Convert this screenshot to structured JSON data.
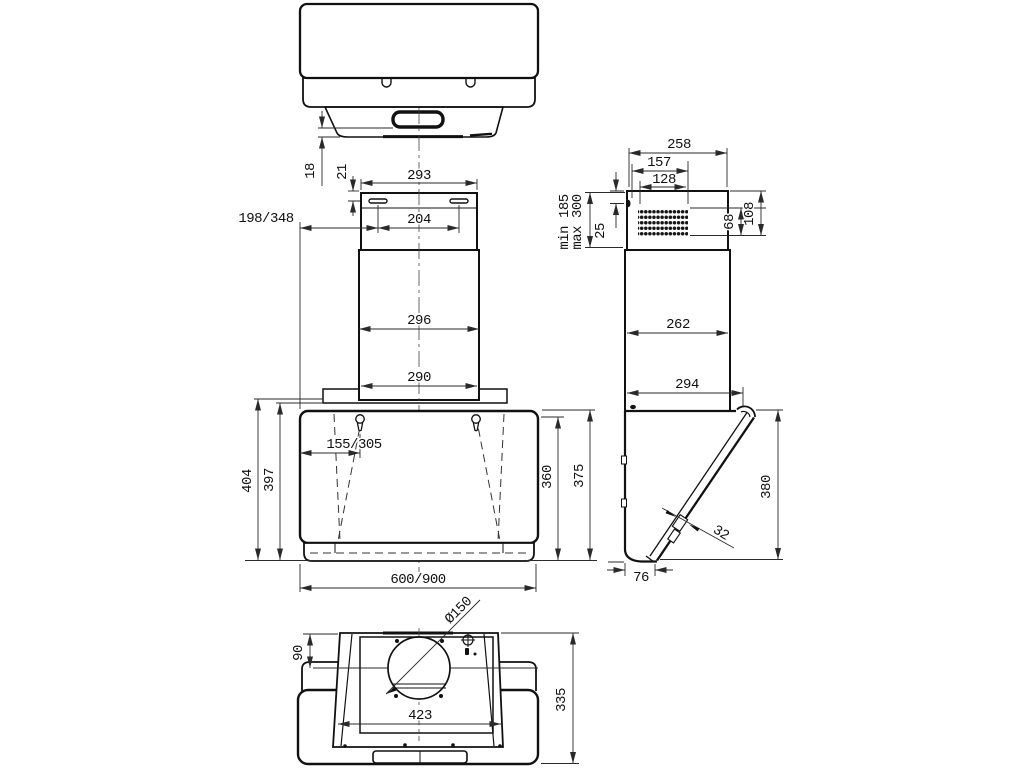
{
  "drawing": {
    "background": "#ffffff",
    "line_color": "#111111"
  },
  "front_view": {
    "lip_height": "18",
    "slot_top_offset": "21",
    "chimney_top_width": "293",
    "slot_spacing": "204",
    "wall_offset": "198/348",
    "chimney_mid_width": "296",
    "chimney_bottom_width": "290",
    "hanger_offset": "155/305",
    "height_total_back": "404",
    "height_back": "397",
    "glass_height": "360",
    "body_height": "375",
    "body_width": "600/900"
  },
  "side_view": {
    "top_depth": "258",
    "vent_offset": "157",
    "vent_width": "128",
    "mount_min": "min 185",
    "mount_max": "max 300",
    "screw_offset": "25",
    "vent_height": "68",
    "vent_bottom_offset": "108",
    "chimney_depth": "262",
    "body_depth": "294",
    "glass_drop": "380",
    "glass_thickness": "32",
    "bottom_depth": "76"
  },
  "bottom_view": {
    "outlet_offset": "90",
    "outlet_diameter": "Ø150",
    "opening_width": "423",
    "total_depth": "335"
  }
}
